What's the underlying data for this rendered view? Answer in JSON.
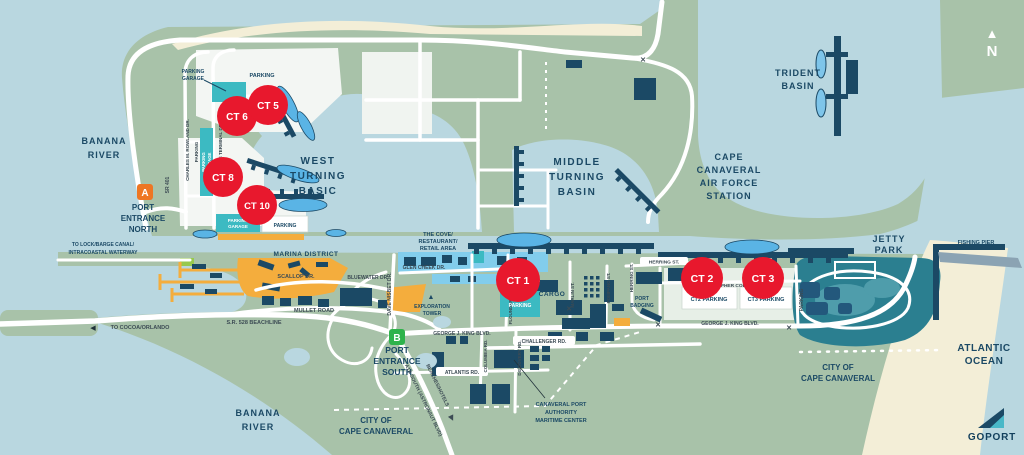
{
  "colors": {
    "water": "#b9d7e0",
    "land": "#a8c2a9",
    "sand": "#f3eed7",
    "road": "#ffffff",
    "navy": "#1b4965",
    "teal": "#3cbac2",
    "sky_blue": "#82cdec",
    "ship_blue": "#5ab4e5",
    "red": "#e8182d",
    "orange": "#f4ad3d",
    "marker_a_orange": "#ee7623",
    "marker_b_green": "#2eb34b",
    "jetty_teal": "#2b7f90",
    "rock_gray": "#8ba3b3"
  },
  "terminals": [
    {
      "label": "CT 6"
    },
    {
      "label": "CT 5"
    },
    {
      "label": "CT 8"
    },
    {
      "label": "CT 10"
    },
    {
      "label": "CT 1"
    },
    {
      "label": "CT 2"
    },
    {
      "label": "CT 3"
    }
  ],
  "markers": {
    "a": "A",
    "b": "B"
  },
  "areas": {
    "banana_river": [
      "BANANA",
      "RIVER"
    ],
    "west_basin": [
      "WEST",
      "TURNING",
      "BASIC"
    ],
    "middle_basin": [
      "MIDDLE",
      "TURNING",
      "BASIN"
    ],
    "trident_basin": [
      "TRIDENT",
      "BASIN"
    ],
    "air_force_station": [
      "CAPE",
      "CANAVERAL",
      "AIR FORCE",
      "STATION"
    ],
    "jetty_park": [
      "JETTY",
      "PARK"
    ],
    "atlantic_ocean": [
      "ATLANTIC",
      "OCEAN"
    ],
    "city_cape_canaveral": [
      "CITY OF",
      "CAPE CANAVERAL"
    ],
    "marina_district": "MARINA DISTRICT",
    "the_cove": [
      "THE COVE/",
      "RESTAURANT/",
      "RETAIL AREA"
    ],
    "cargo": "CARGO",
    "port_entrance_north": [
      "PORT",
      "ENTRANCE",
      "NORTH"
    ],
    "port_entrance_south": [
      "PORT",
      "ENTRANCE",
      "SOUTH"
    ],
    "exploration_tower": [
      "EXPLORATION",
      "TOWER"
    ],
    "port_badging": [
      "PORT",
      "BADGING"
    ],
    "maritime_center": [
      "CANAVERAL PORT",
      "AUTHORITY",
      "MARITIME CENTER"
    ],
    "fishing_pier": "FISHING PIER",
    "north": "N"
  },
  "streets": {
    "sr401": "SR 401",
    "charles_rowland": "CHARLES M. ROWLAND DR.",
    "cruise_terminal": "CRUISE TERMINAL DR.",
    "scallop": "SCALLOP DR.",
    "bluewater": "BLUEWATER DR.",
    "glen_cheek": "GLEN CHEEK DR.",
    "mullet": "MULLET ROAD",
    "sr528": "S.R. 528 BEACHLINE",
    "dave_nisbet": "DAVE NISBET DR.",
    "george_king": "GEORGE J. KING BLVD.",
    "challenger": "CHALLENGER RD.",
    "atlantis": "ATLANTIS RD.",
    "columbia": "COLUMBIA RD.",
    "discovery": "DISCOVERY RD.",
    "flounder": "FLOUNDER ST.",
    "marlin": "MARLIN ST.",
    "pompano": "POMPANO ST.",
    "herring": "HERRING ST.",
    "christopher_columbus": "CHRISTOPHER COLUMBUS DR.",
    "a1a": "A1A SOUTH (ASTRONAUT BLVD)",
    "beaches_hotels": "BEACHES/HOTELS",
    "to_cocoa": "TO COCOA/ORLANDO",
    "to_lock": [
      "TO LOCK/BARGE CANAL/",
      "INTRACOASTAL WATERWAY"
    ]
  },
  "parking": {
    "parking": "PARKING",
    "garage": [
      "PARKING",
      "GARAGE"
    ],
    "ct2": "CT2 PARKING",
    "ct3": "CT3 PARKING"
  },
  "icons": {
    "north_arrow": "▲",
    "gate": "✕",
    "arrow_left": "◀",
    "arrow_right": "▶",
    "tower": "▲"
  },
  "logo": {
    "text": "GOPORT"
  }
}
